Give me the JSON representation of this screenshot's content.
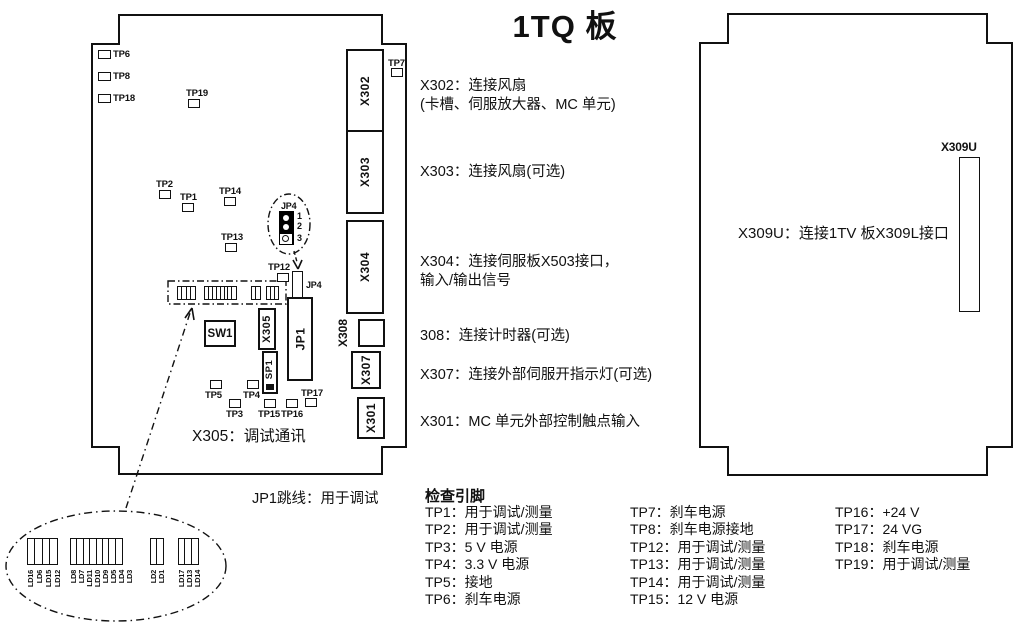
{
  "title": "1TQ 板",
  "left_board": {
    "testpoints": {
      "tp1": "TP1",
      "tp2": "TP2",
      "tp3": "TP3",
      "tp4": "TP4",
      "tp5": "TP5",
      "tp6": "TP6",
      "tp7": "TP7",
      "tp8": "TP8",
      "tp12": "TP12",
      "tp13": "TP13",
      "tp14": "TP14",
      "tp15": "TP15",
      "tp16": "TP16",
      "tp17": "TP17",
      "tp18": "TP18",
      "tp19": "TP19"
    },
    "connectors": {
      "x302": "X302",
      "x303": "X303",
      "x304": "X304",
      "x308": "X308",
      "x307": "X307",
      "x301": "X301",
      "x305": "X305",
      "jp1": "JP1",
      "sp1": "SP1",
      "sw1": "SW1",
      "jp4": "JP4"
    },
    "jp4_detail": {
      "label": "JP4",
      "pins": [
        "1",
        "2",
        "3"
      ]
    },
    "caption": "X305：调试通讯"
  },
  "annotations": [
    {
      "lines": [
        "X302：连接风扇",
        "(卡槽、伺服放大器、MC 单元)"
      ]
    },
    {
      "lines": [
        "X303：连接风扇(可选)"
      ]
    },
    {
      "lines": [
        "X304：连接伺服板X503接口，",
        "输入/输出信号"
      ]
    },
    {
      "lines": [
        "308：连接计时器(可选)"
      ]
    },
    {
      "lines": [
        "X307：连接外部伺服开指示灯(可选)"
      ]
    },
    {
      "lines": [
        "X301：MC 单元外部控制触点输入"
      ]
    }
  ],
  "right_board": {
    "connector": "X309U",
    "note": "X309U：连接1TV 板X309L接口"
  },
  "jp1_note": "JP1跳线：用于调试",
  "check_pins": {
    "header": "检查引脚",
    "col1": [
      "TP1：用于调试/测量",
      "TP2：用于调试/测量",
      "TP3：5 V 电源",
      "TP4：3.3 V 电源",
      "TP5：接地",
      "TP6：刹车电源"
    ],
    "col2": [
      "TP7：刹车电源",
      "TP8：刹车电源接地",
      "TP12：用于调试/测量",
      "TP13：用于调试/测量",
      "TP14：用于调试/测量",
      "TP15：12 V 电源"
    ],
    "col3": [
      "TP16：+24 V",
      "TP17：24 VG",
      "TP18：刹车电源",
      "TP19：用于调试/测量"
    ]
  },
  "led_detail": {
    "labels": [
      "LD16",
      "LD6",
      "LD15",
      "LD12",
      "LD8",
      "LD7",
      "LD11",
      "LD10",
      "LD9",
      "LD5",
      "LD4",
      "LD3",
      "LD2",
      "LD1",
      "LD17",
      "LD13",
      "LD14"
    ]
  }
}
